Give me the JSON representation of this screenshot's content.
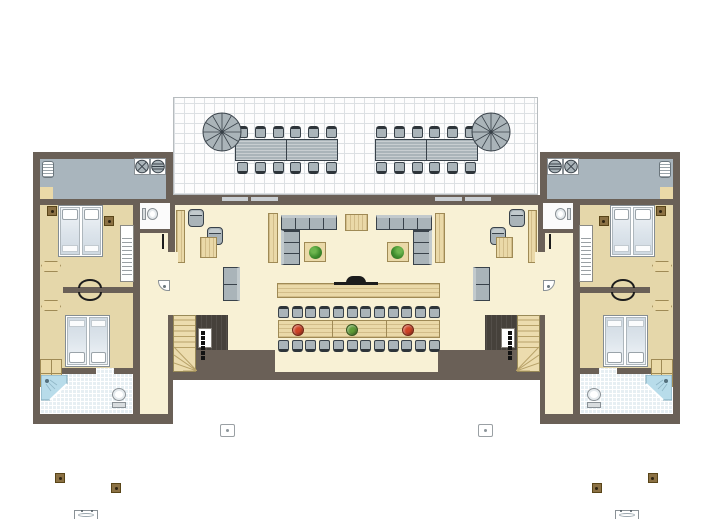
{
  "colors": {
    "wall": "#6a6057",
    "floor_living": "#f8f1d5",
    "floor_bedroom": "#e5d7aa",
    "floor_balcony": "#a9b5bd",
    "floor_bath": "#e7eff3",
    "floor_wc": "#fbfbfb",
    "terrace_bg": "#fdfdfd",
    "terrace_grid": "#dce0e3",
    "terrace_border": "#b7bcbf",
    "furn_gray": "#aab4b9",
    "furn_gray_mid": "#c2cacd",
    "furn_gray_dark": "#39424a",
    "chair_back": "#2d3439",
    "wood": "#ead9a8",
    "wood_border": "#9f8a55",
    "counter_dark": "#46413b",
    "stairs_wood": "#ecdcae",
    "stairs_line": "#b8a269",
    "bed_fill": "#dce4eb",
    "bed_border": "#848d93",
    "nightstand": "#8b7144",
    "nightstand_border": "#594518",
    "shower": "#b8dcea",
    "plant": "#3e8d2d",
    "door_bar": "#c9ced2",
    "black": "#1c1c1c",
    "bowl_red": "#cf4326",
    "bowl_green": "#5f9c36"
  },
  "counts": {
    "terrace_chairs_per_side": 6,
    "dining_chairs_per_side": 12,
    "stove_burners": 6,
    "parasol_segments": 12,
    "terrace_tables_per_side": 2,
    "dining_table_sections": 3
  },
  "dining_bowls": [
    "bowl_red",
    "bowl_green",
    "bowl_red"
  ]
}
